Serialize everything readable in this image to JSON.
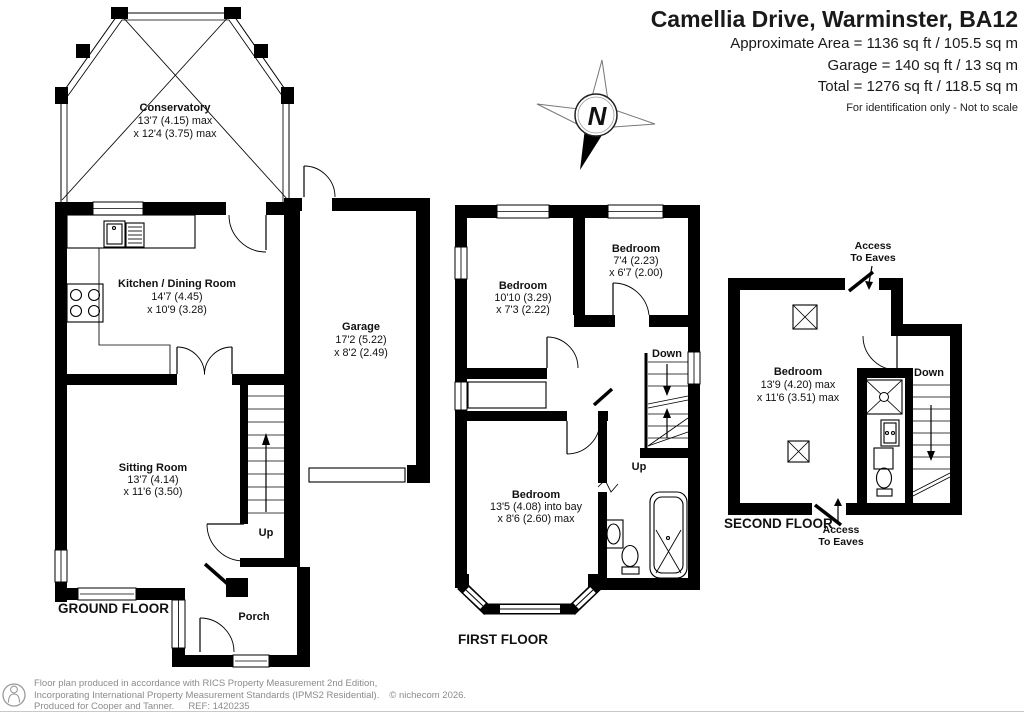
{
  "header": {
    "title": "Camellia Drive, Warminster, BA12",
    "area_lines": [
      "Approximate Area = 1136 sq ft / 105.5 sq m",
      "Garage = 140 sq ft / 13 sq m",
      "Total = 1276 sq ft / 118.5 sq m"
    ],
    "disclaimer": "For identification only - Not to scale"
  },
  "compass": {
    "north": "N"
  },
  "floors": {
    "ground": {
      "label": "GROUND FLOOR",
      "up": "Up",
      "conservatory": {
        "name": "Conservatory",
        "dim1": "13'7 (4.15) max",
        "dim2": "x 12'4 (3.75) max"
      },
      "kitchen": {
        "name": "Kitchen / Dining Room",
        "dim1": "14'7 (4.45)",
        "dim2": "x 10'9 (3.28)"
      },
      "garage": {
        "name": "Garage",
        "dim1": "17'2 (5.22)",
        "dim2": "x 8'2 (2.49)"
      },
      "sitting_room": {
        "name": "Sitting Room",
        "dim1": "13'7 (4.14)",
        "dim2": "x 11'6 (3.50)"
      },
      "porch": {
        "name": "Porch"
      }
    },
    "first": {
      "label": "FIRST FLOOR",
      "down": "Down",
      "up": "Up",
      "bedroom1": {
        "name": "Bedroom",
        "dim1": "10'10 (3.29)",
        "dim2": "x 7'3 (2.22)"
      },
      "bedroom2": {
        "name": "Bedroom",
        "dim1": "7'4 (2.23)",
        "dim2": "x 6'7 (2.00)"
      },
      "bedroom3": {
        "name": "Bedroom",
        "dim1": "13'5 (4.08) into bay",
        "dim2": "x 8'6 (2.60) max"
      }
    },
    "second": {
      "label": "SECOND FLOOR",
      "down": "Down",
      "bedroom": {
        "name": "Bedroom",
        "dim1": "13'9 (4.20) max",
        "dim2": "x 11'6 (3.51) max"
      },
      "access_eaves": {
        "line1": "Access",
        "line2": "To Eaves"
      }
    }
  },
  "footer": {
    "line1": "Floor plan produced in accordance with RICS Property Measurement 2nd Edition,",
    "line2": "Incorporating International Property Measurement Standards (IPMS2 Residential).",
    "copyright": "© nichecom 2026.",
    "produced": "Produced for Cooper and Tanner.",
    "ref": "REF: 1420235"
  }
}
